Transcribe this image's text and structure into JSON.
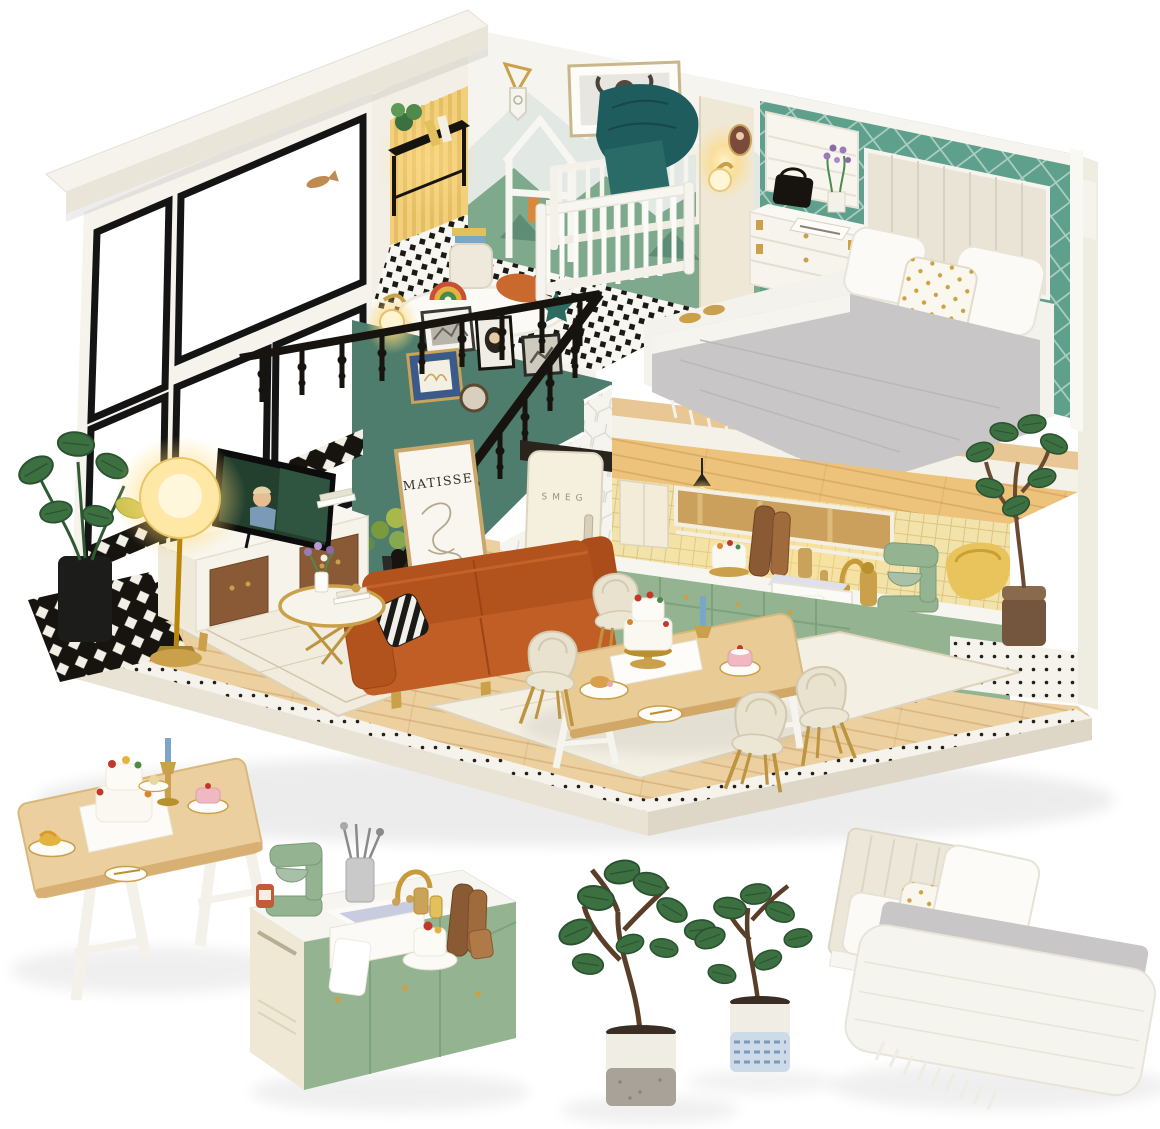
{
  "scene": {
    "type": "product photograph",
    "subject": "DIY miniature dollhouse loft kit with separate furniture miniatures",
    "labels": {
      "poster_title": "MATISSE",
      "fridge_brand": "SMEG"
    },
    "rooms": [
      "nursery loft",
      "bedroom loft",
      "staircase with gallery wall",
      "living room",
      "kitchen",
      "dining area"
    ],
    "house_objects": [
      "white crib",
      "highland cow art",
      "house-shaped clothes rack",
      "double bed with channel headboard",
      "white dresser",
      "roman shade window",
      "black banister",
      "wall sconces",
      "MATISSE poster",
      "SMEG fridge",
      "orange sofa",
      "striped pillow",
      "TV on walnut console",
      "glowing floor lamp",
      "gold coffee table",
      "monstera plant",
      "sage green kitchen cabinets",
      "stand mixer",
      "farmhouse sink",
      "dining table with cakes",
      "four cream chairs",
      "fiddle leaf fig",
      "yellow tub chair"
    ],
    "miniatures": [
      "wooden dining table with cakes and candle",
      "sage kitchen sink cabinet with mixer and cutting boards",
      "two potted fiddle leaf fig plants",
      "double bed with pillows and fringed duvet"
    ]
  },
  "colors": {
    "roof": "#f6f3ed",
    "wall_white": "#f6f4ee",
    "teal_wall": "#4e7d6e",
    "teal_wallpaper": "#5fa08c",
    "mountain_green": "#7fa98c",
    "sage": "#93b391",
    "wood_floor": "#ecd0a0",
    "wood_mid": "#e9c794",
    "gold": "#c79a3a",
    "black": "#17140f",
    "sofa_orange": "#bf5c24",
    "cream": "#efe8d6",
    "gray_blanket": "#c9c6c8",
    "teal_dark": "#1f5c5e",
    "tile_yellow": "#f2e3ab",
    "leaf_green": "#3c7040",
    "glow": "#ffd978"
  }
}
